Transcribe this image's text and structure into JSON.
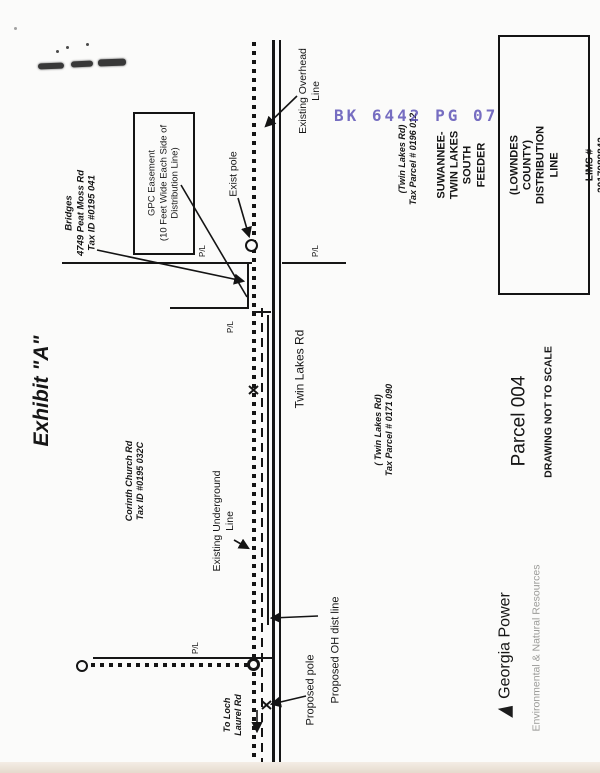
{
  "page": {
    "exhibit_title": "Exhibit \"A\"",
    "stamp_text": "BK 6442 PG 07",
    "parcel_label": "Parcel 004",
    "scale_note": "DRAWING NOT TO SCALE"
  },
  "title_block": {
    "line1": "SUWANNEE-TWIN LAKES SOUTH FEEDER",
    "line2": "(LOWNDES COUNTY) DISTRIBUTION LINE",
    "line3": "LIMS # 2017088842",
    "line4": "Work Location(s): N/A"
  },
  "labels": {
    "bridges": "Bridges\n4749 Peat Moss Rd\nTax ID #0195 041",
    "gpc_easement": "GPC Easement\n(10 Feet Wide Each Side of\nDistribution Line)",
    "exist_pole": "Exist pole",
    "existing_overhead": "Existing Overhead\nLine",
    "twin_lakes_rd": "Twin Lakes Rd",
    "parcel_0196": "(Twin Lakes Rd)\nTax Parcel # 0196 012",
    "parcel_0171": "( Twin Lakes Rd)\nTax Parcel # 0171 090",
    "corinth_church": "Corinth Church Rd\nTax ID #0195 032C",
    "existing_underground": "Existing Underground\nLine",
    "proposed_oh_line": "Proposed  OH dist line",
    "proposed_pole": "Proposed pole",
    "to_loch_laurel": "To Loch\nLaurel Rd",
    "pl": "P/L"
  },
  "footer": {
    "brand": "Georgia Power",
    "division": "Environmental & Natural Resources"
  },
  "icons": {
    "logo": "georgia-power-triangle-icon"
  },
  "colors": {
    "stamp": "#5f55b8",
    "ink": "#161616",
    "gray_text": "#9b9b98"
  }
}
